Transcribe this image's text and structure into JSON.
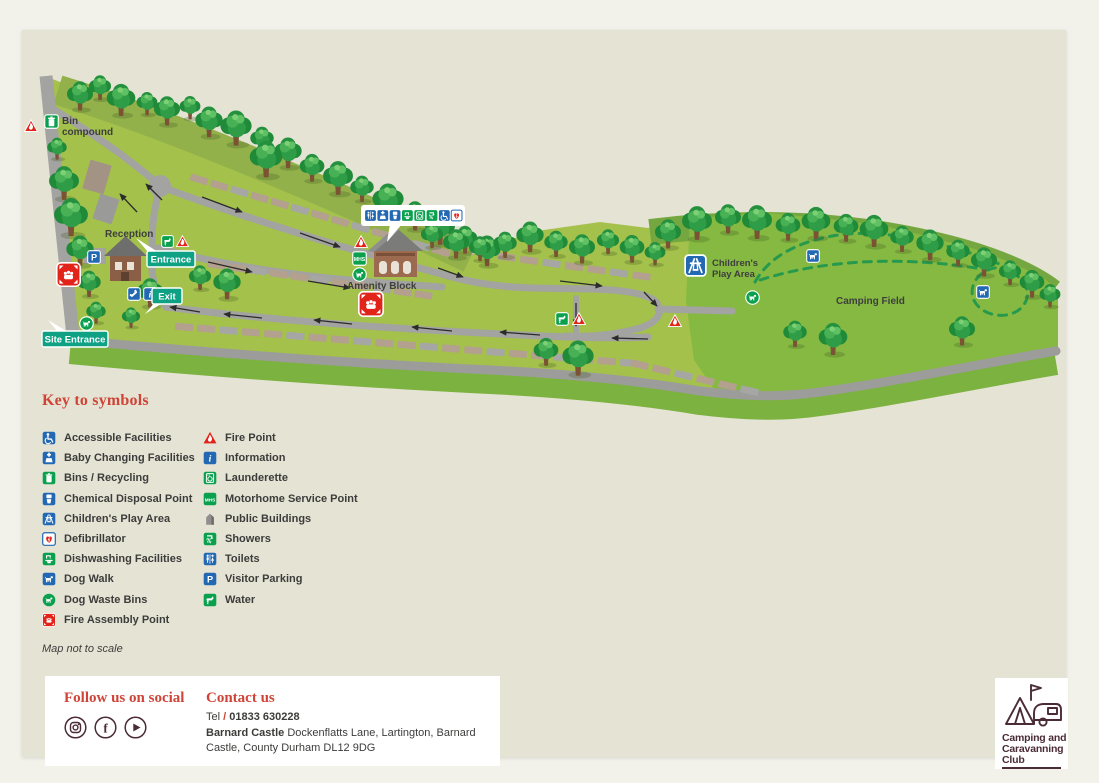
{
  "page": {
    "background": "#f3f2ea",
    "panel_background": "#e5e3d4"
  },
  "map": {
    "labels": {
      "bin_line1": "Bin",
      "bin_line2": "compound",
      "reception": "Reception",
      "amenity_block": "Amenity Block",
      "play_line1": "Children's",
      "play_line2": "Play Area",
      "camping_field": "Camping Field"
    },
    "callouts": {
      "entrance": "Entrance",
      "exit": "Exit",
      "site_entrance": "Site Entrance"
    },
    "amenity_strip": [
      "toilets",
      "baby-changing",
      "chemical-disposal",
      "dishwashing",
      "launderette",
      "showers",
      "accessible",
      "defibrillator"
    ],
    "icon_names": [
      "fire-point-icon",
      "bins-icon",
      "water-icon",
      "visitor-parking-icon",
      "fire-assembly-icon",
      "telephone-icon",
      "information-icon",
      "dog-waste-icon",
      "motorhome-service-icon",
      "childrens-play-icon",
      "dog-walk-icon"
    ]
  },
  "key": {
    "title": "Key to symbols",
    "note": "Map not to scale",
    "col1": [
      {
        "icon": "accessible",
        "label": "Accessible Facilities"
      },
      {
        "icon": "baby-changing",
        "label": "Baby Changing Facilities"
      },
      {
        "icon": "bins",
        "label": "Bins / Recycling"
      },
      {
        "icon": "chemical-disposal",
        "label": "Chemical Disposal Point"
      },
      {
        "icon": "play",
        "label": "Children's Play Area"
      },
      {
        "icon": "defibrillator",
        "label": "Defibrillator"
      },
      {
        "icon": "dishwashing",
        "label": "Dishwashing Facilities"
      },
      {
        "icon": "dogwalk",
        "label": "Dog Walk"
      },
      {
        "icon": "dogwaste",
        "label": "Dog Waste Bins"
      },
      {
        "icon": "fireassembly",
        "label": "Fire Assembly Point"
      }
    ],
    "col2": [
      {
        "icon": "firepoint",
        "label": "Fire Point"
      },
      {
        "icon": "info",
        "label": "Information"
      },
      {
        "icon": "launderette",
        "label": "Launderette"
      },
      {
        "icon": "mhs",
        "label": "Motorhome Service Point"
      },
      {
        "icon": "public",
        "label": "Public Buildings"
      },
      {
        "icon": "showers",
        "label": "Showers"
      },
      {
        "icon": "toilets",
        "label": "Toilets"
      },
      {
        "icon": "parking",
        "label": "Visitor Parking"
      },
      {
        "icon": "water",
        "label": "Water"
      }
    ]
  },
  "footer": {
    "social_title": "Follow us on social",
    "social_icons": [
      "instagram-icon",
      "facebook-icon",
      "youtube-icon"
    ],
    "contact_title": "Contact us",
    "tel_prefix": "Tel",
    "tel_slash": "/",
    "tel_number": "01833 630228",
    "address_bold": "Barnard Castle",
    "address_rest": " Dockenflatts Lane, Lartington, Barnard Castle, County Durham DL12 9DG"
  },
  "logo": {
    "line1": "Camping and",
    "line2": "Caravanning",
    "line3": "Club"
  },
  "colors": {
    "accent_red": "#cf4437",
    "teal_label": "#0fa184",
    "icon_blue": "#2268b2",
    "icon_green": "#0aa04e",
    "fire_red": "#e2231a",
    "brand_maroon": "#4a2b36",
    "site_green": "#a3c14b",
    "field_green": "#85b942",
    "road_grey": "#a3a3a1"
  }
}
